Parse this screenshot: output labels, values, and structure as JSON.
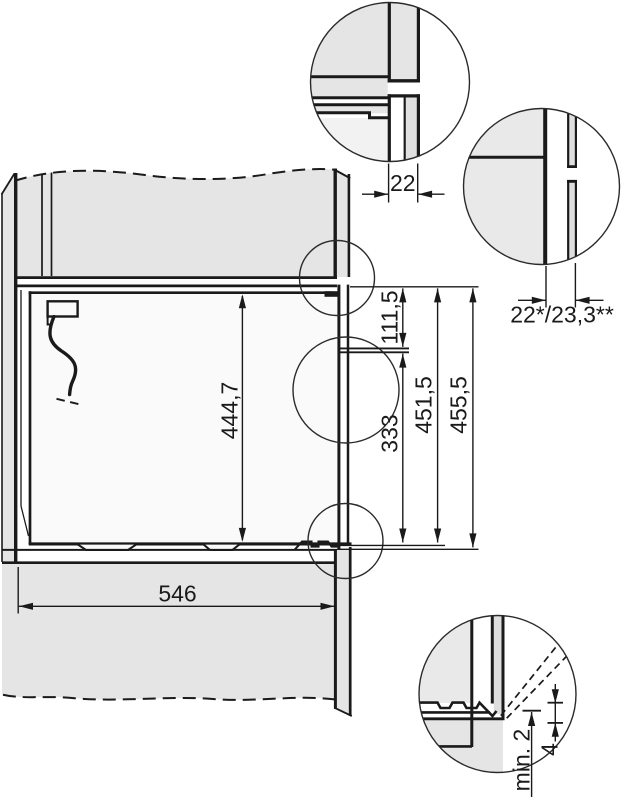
{
  "dims": {
    "top_gap": "22",
    "side_gap": "22*/23,3**",
    "upper_offset": "111,5",
    "niche_height": "444,7",
    "lower_offset": "333",
    "inner_height_1": "451,5",
    "inner_height_2": "455,5",
    "niche_width": "546",
    "bottom_clearance": "min. 2",
    "bottom_overlap": "4"
  },
  "colors": {
    "line": "#1a1a1a",
    "panel_gray": "#e5e5e5",
    "panel_light": "#f2f2f2",
    "niche_fill": "#fafafa",
    "background": "#ffffff"
  }
}
